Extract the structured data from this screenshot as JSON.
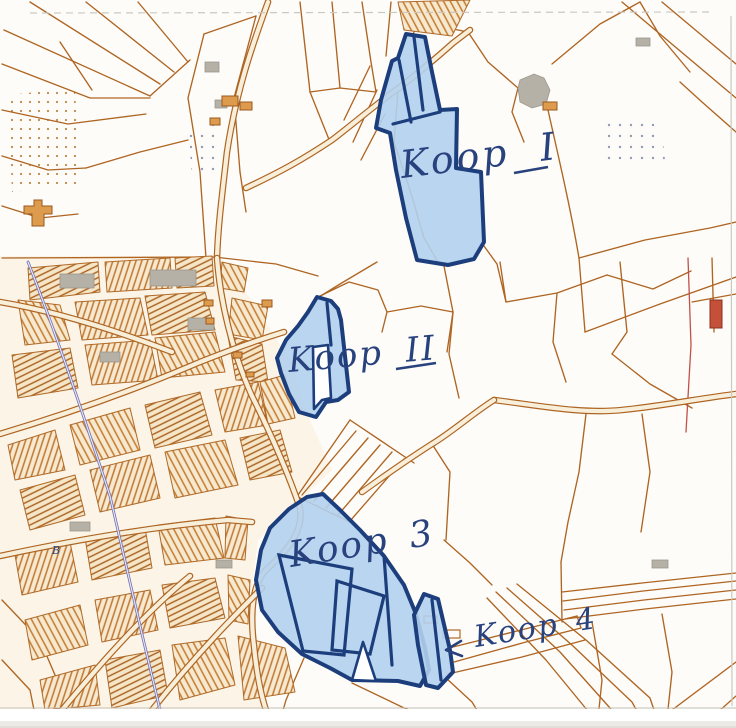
{
  "map": {
    "parcels": [
      {
        "id": "koop-1",
        "label": "Koop I",
        "underlined_part": "I"
      },
      {
        "id": "koop-2",
        "label": "Koop II",
        "underlined_part": "II"
      },
      {
        "id": "koop-3",
        "label": "Koop 3"
      },
      {
        "id": "koop-4",
        "label": "Koop 4",
        "pointer_icon": "left-arrow"
      }
    ],
    "other_labels": {
      "b": "B"
    },
    "colors": {
      "paper": "#fefcf8",
      "parcel_line": "#ae6523",
      "road_fill": "#f8efda",
      "urban_block": "#f7e9cf",
      "hatch": "#bf7631",
      "building_gray": "#b6b1a6",
      "building_orange": "#dd9b4d",
      "building_red": "#c4503a",
      "highlight_fill": "#b3d0ed",
      "highlight_border": "#1d3e7c",
      "ink": "#28427e",
      "canal": "#7474b4",
      "scan_edge": "#c9c8c2"
    }
  }
}
